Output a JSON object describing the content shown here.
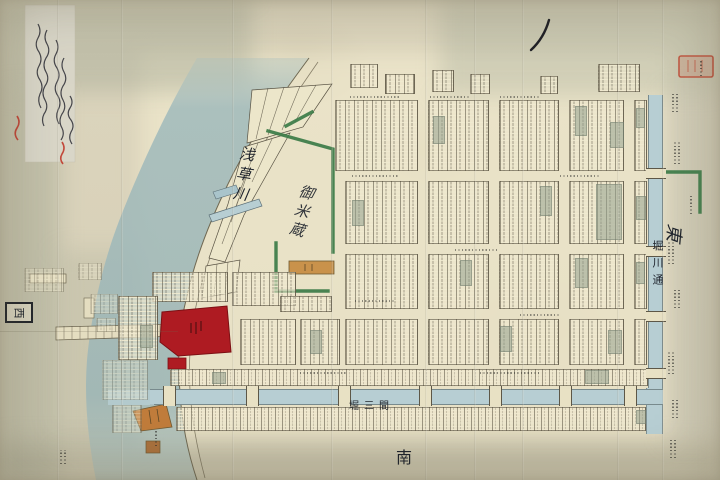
{
  "labels": {
    "river": "浅草川",
    "granary": "御米蔵",
    "canal_street": "堀川通",
    "bottom_canal": "堀三間",
    "direction_east": "東",
    "direction_west": "西",
    "direction_south": "南"
  },
  "colors": {
    "paper": "#d8d1ba",
    "land": "#ece6ca",
    "river": "#a4bcbc",
    "canal": "#b7ced3",
    "hedge_green": "#3c7c48",
    "temple_red": "#ae1b22",
    "seal_red": "#c05a45",
    "building_orange": "#c9924b",
    "ink": "#1d222b"
  },
  "map": {
    "blocks": [
      [
        335,
        100,
        83,
        71
      ],
      [
        428,
        100,
        61,
        71
      ],
      [
        499,
        100,
        60,
        71
      ],
      [
        569,
        100,
        55,
        71
      ],
      [
        634,
        100,
        13,
        71
      ],
      [
        350,
        64,
        28,
        24
      ],
      [
        385,
        74,
        30,
        20
      ],
      [
        432,
        70,
        22,
        22
      ],
      [
        470,
        74,
        20,
        20
      ],
      [
        540,
        76,
        18,
        18
      ],
      [
        598,
        64,
        42,
        28
      ],
      [
        345,
        181,
        73,
        63
      ],
      [
        428,
        181,
        61,
        63
      ],
      [
        499,
        181,
        60,
        63
      ],
      [
        569,
        181,
        55,
        63
      ],
      [
        634,
        181,
        13,
        63
      ],
      [
        345,
        254,
        73,
        55
      ],
      [
        428,
        254,
        61,
        55
      ],
      [
        499,
        254,
        60,
        55
      ],
      [
        569,
        254,
        55,
        55
      ],
      [
        634,
        254,
        13,
        55
      ],
      [
        345,
        319,
        73,
        46
      ],
      [
        428,
        319,
        61,
        46
      ],
      [
        499,
        319,
        60,
        46
      ],
      [
        569,
        319,
        55,
        46
      ],
      [
        634,
        319,
        13,
        46
      ],
      [
        300,
        319,
        40,
        46
      ],
      [
        240,
        319,
        56,
        46
      ],
      [
        152,
        272,
        76,
        30
      ],
      [
        232,
        272,
        64,
        34
      ],
      [
        280,
        296,
        52,
        16
      ],
      [
        118,
        296,
        40,
        64
      ],
      [
        170,
        369,
        478,
        17,
        "strip"
      ],
      [
        176,
        407,
        470,
        24,
        "strip"
      ],
      [
        24,
        268,
        40,
        24,
        "faint"
      ],
      [
        78,
        263,
        24,
        17,
        "faint"
      ],
      [
        90,
        294,
        28,
        20,
        "faint"
      ],
      [
        96,
        318,
        20,
        14,
        "faint"
      ],
      [
        102,
        360,
        46,
        40,
        "faint"
      ],
      [
        112,
        405,
        30,
        28,
        "faint"
      ]
    ],
    "shaded_lots": [
      [
        575,
        106,
        12,
        30
      ],
      [
        610,
        122,
        14,
        26
      ],
      [
        636,
        108,
        9,
        20
      ],
      [
        433,
        116,
        12,
        28
      ],
      [
        540,
        186,
        12,
        30
      ],
      [
        596,
        184,
        26,
        56
      ],
      [
        636,
        196,
        10,
        24
      ],
      [
        352,
        200,
        12,
        26
      ],
      [
        460,
        260,
        12,
        26
      ],
      [
        575,
        258,
        13,
        30
      ],
      [
        636,
        262,
        9,
        22
      ],
      [
        310,
        330,
        12,
        24
      ],
      [
        500,
        326,
        12,
        26
      ],
      [
        608,
        330,
        14,
        24
      ],
      [
        636,
        410,
        10,
        14
      ],
      [
        585,
        370,
        24,
        14
      ],
      [
        140,
        325,
        13,
        23
      ],
      [
        212,
        372,
        14,
        12
      ]
    ],
    "bridges_vertical_canal_y": [
      168,
      246,
      311,
      368
    ],
    "bridges_horizontal_canal_x": [
      163,
      246,
      338,
      419,
      489,
      559,
      624
    ],
    "creases_x": [
      57,
      121,
      232,
      331,
      425,
      474,
      522,
      617,
      662
    ],
    "margin_texts": [
      [
        672,
        92,
        20,
        2
      ],
      [
        700,
        60,
        16,
        1
      ],
      [
        674,
        140,
        24,
        2
      ],
      [
        690,
        196,
        18,
        1
      ],
      [
        668,
        242,
        22,
        2
      ],
      [
        674,
        288,
        20,
        2
      ],
      [
        668,
        352,
        22,
        2
      ],
      [
        672,
        398,
        20,
        2
      ],
      [
        670,
        440,
        18,
        2
      ],
      [
        155,
        430,
        16,
        1
      ],
      [
        60,
        450,
        14,
        2
      ]
    ],
    "street_marks": [
      [
        350,
        96,
        50
      ],
      [
        430,
        96,
        40
      ],
      [
        500,
        96,
        40
      ],
      [
        352,
        175,
        46
      ],
      [
        560,
        175,
        40
      ],
      [
        455,
        249,
        44
      ],
      [
        520,
        314,
        40
      ],
      [
        300,
        372,
        46
      ],
      [
        480,
        372,
        60
      ],
      [
        355,
        300,
        40
      ]
    ]
  }
}
